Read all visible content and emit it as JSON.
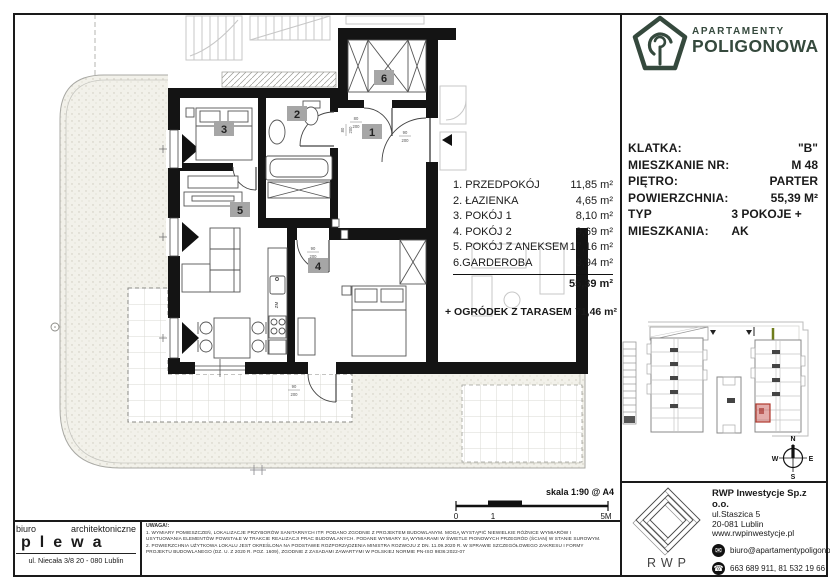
{
  "logo": {
    "line1": "APARTAMENTY",
    "line2": "POLIGONOWA",
    "color": "#35493d"
  },
  "info": {
    "rows": [
      {
        "label": "KLATKA:",
        "value": "\"B\""
      },
      {
        "label": "MIESZKANIE NR:",
        "value": "M  48"
      },
      {
        "label": "PIĘTRO:",
        "value": "PARTER"
      },
      {
        "label": "POWIERZCHNIA:",
        "value": "55,39 M²"
      },
      {
        "label": "TYP MIESZKANIA:",
        "value": "3 POKOJE + AK"
      }
    ]
  },
  "rooms": {
    "items": [
      {
        "name": "1. PRZEDPOKÓJ",
        "area": "11,85 m²"
      },
      {
        "name": "2. ŁAZIENKA",
        "area": "4,65 m²"
      },
      {
        "name": "3. POKÓJ 1",
        "area": "8,10 m²"
      },
      {
        "name": "4. POKÓJ 2",
        "area": "9,69 m²"
      },
      {
        "name": "5. POKÓJ Z ANEKSEM",
        "area": "17,16 m²"
      },
      {
        "name": "6.GARDEROBA",
        "area": "3,94 m²"
      }
    ],
    "total": "55,39 m²",
    "garden": {
      "label": "+ OGRÓDEK Z TARASEM",
      "value": "71,46 m²"
    }
  },
  "plan": {
    "badges": [
      "1",
      "2",
      "3",
      "4",
      "5",
      "6"
    ],
    "kitchen_label": "ZM",
    "dims": [
      {
        "t": "90",
        "b": "200"
      },
      {
        "t": "80",
        "b": "200"
      },
      {
        "t": "80",
        "b": "200"
      },
      {
        "t": "90",
        "b": "200"
      },
      {
        "t": "90",
        "b": "200"
      }
    ]
  },
  "scale": {
    "label": "skala 1:90 @ A4",
    "tick0": "0",
    "tick1": "1",
    "tick2": "5M"
  },
  "compass": {
    "n": "N",
    "s": "S",
    "w": "W",
    "e": "E"
  },
  "architect": {
    "line1a": "biuro",
    "line1b": "architektoniczne",
    "name": "plewa",
    "address": "ul. Niecała 3/8  20 - 080 Lublin"
  },
  "uwagi": {
    "title": "UWAGA!:",
    "lines": [
      "1. WYMIARY POMIESZCZEŃ, LOKALIZACJE PRZYBORÓW SANITARNYCH ITP. PODANO ZGODNIE Z PROJEKTEM BUDOWLANYM. MOGĄ WYSTĄPIĆ NIEWIELKIE RÓŻNICE WYMIARÓW I",
      "USYTUOWANIA ELEMENTÓW POWSTAŁE W TRAKCIE REALIZACJI PRAC BUDOWLANYCH. PODANE WYMIARY SĄ WYMIARAMI W ŚWIETLE PIONOWYCH PRZEGRÓD (ŚCIAN) W STANIE SUROWYM.",
      "2. POWIERZCHNIA UŻYTKOWA LOKALU JEST OKREŚLONA NA PODSTAWIE ROZPORZĄDZENIA MINISTRA ROZWOJU Z DN. 11.09.2020 R. W SPRAWIE SZCZEGÓŁOWEGO ZAKRESU I FORMY",
      "PROJEKTU BUDOWLANEGO (DZ. U. Z 2020 R. POZ. 1609), ZGODNIE Z ZASADAMI ZAWARTYMI W POLSKIEJ NORMIE PN-ISO 9836:2022-07"
    ]
  },
  "developer": {
    "logo_text": "RWP",
    "name": "RWP Inwestycje Sp.z o.o.",
    "address1": "ul.Staszica 5",
    "address2": "20-081 Lublin",
    "website": "www.rwpinwestycje.pl",
    "email": "biuro@apartamentypoligonowa.pl",
    "phones": "663 689 911,  81 532 19 66"
  }
}
